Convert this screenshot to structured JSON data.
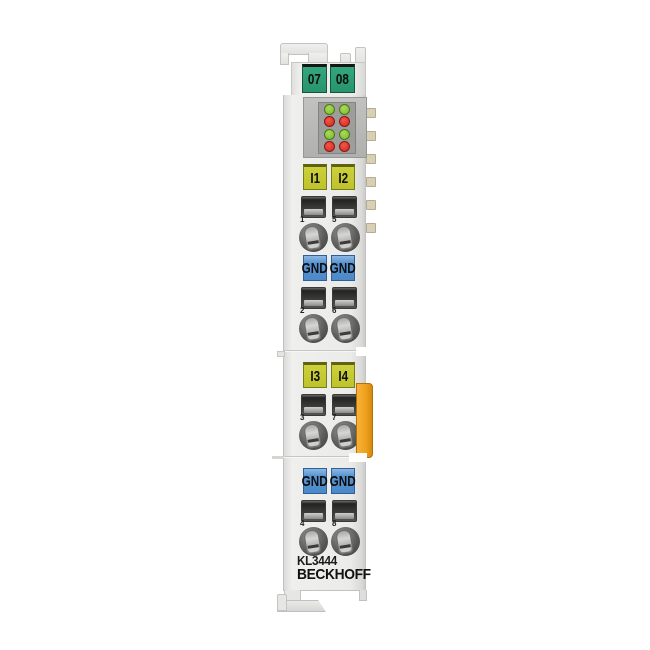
{
  "device": {
    "model": "KL3444",
    "brand": "BECKHOFF"
  },
  "address_labels": [
    "07",
    "08"
  ],
  "led_panel": {
    "description": "status-led-matrix 2 columns x 4 rows",
    "leds": [
      "green",
      "green",
      "red",
      "red",
      "green",
      "green",
      "red",
      "red"
    ]
  },
  "groups": [
    {
      "kind": "input",
      "labels": [
        "I1",
        "I2"
      ],
      "numbers": [
        "1",
        "5"
      ]
    },
    {
      "kind": "ground",
      "labels": [
        "GND",
        "GND"
      ],
      "numbers": [
        "2",
        "6"
      ]
    },
    {
      "kind": "input",
      "labels": [
        "I3",
        "I4"
      ],
      "numbers": [
        "3",
        "7"
      ]
    },
    {
      "kind": "ground",
      "labels": [
        "GND",
        "GND"
      ],
      "numbers": [
        "4",
        "8"
      ]
    }
  ],
  "colors": {
    "address_label_green": "#2aa077",
    "input_label_yellow": "#c3c832",
    "ground_label_blue": "#4c89c8",
    "led_green": "#85c438",
    "led_red": "#dd352a",
    "latch_orange": "#f0a11f",
    "housing_gray": "#ebebe9"
  }
}
